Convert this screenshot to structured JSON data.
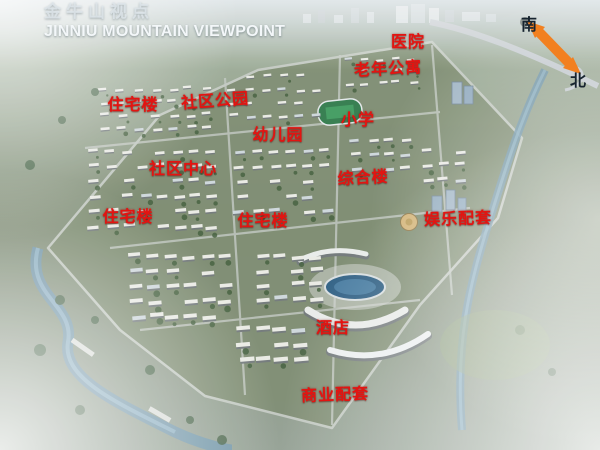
{
  "header": {
    "title_zh": "金牛山视点",
    "title_en": "JINNIU MOUNTAIN VIEWPOINT"
  },
  "compass": {
    "south_label": "南",
    "north_label": "北"
  },
  "map_labels": [
    {
      "name": "hospital",
      "text": "医院"
    },
    {
      "name": "senior-apartments",
      "text": "老年公寓"
    },
    {
      "name": "residential-building-1",
      "text": "住宅楼"
    },
    {
      "name": "community-park",
      "text": "社区公园"
    },
    {
      "name": "kindergarten",
      "text": "幼儿园"
    },
    {
      "name": "primary-school",
      "text": "小学"
    },
    {
      "name": "community-center",
      "text": "社区中心"
    },
    {
      "name": "mixed-use-building",
      "text": "综合楼"
    },
    {
      "name": "residential-building-2",
      "text": "住宅楼"
    },
    {
      "name": "residential-building-3",
      "text": "住宅楼"
    },
    {
      "name": "entertainment-facilities",
      "text": "娱乐配套"
    },
    {
      "name": "hotel",
      "text": "酒店"
    },
    {
      "name": "commercial-facilities",
      "text": "商业配套"
    }
  ],
  "colors": {
    "label_red": "#e31411",
    "compass_orange": "#f28020",
    "title_white": "#f3f7f9"
  }
}
